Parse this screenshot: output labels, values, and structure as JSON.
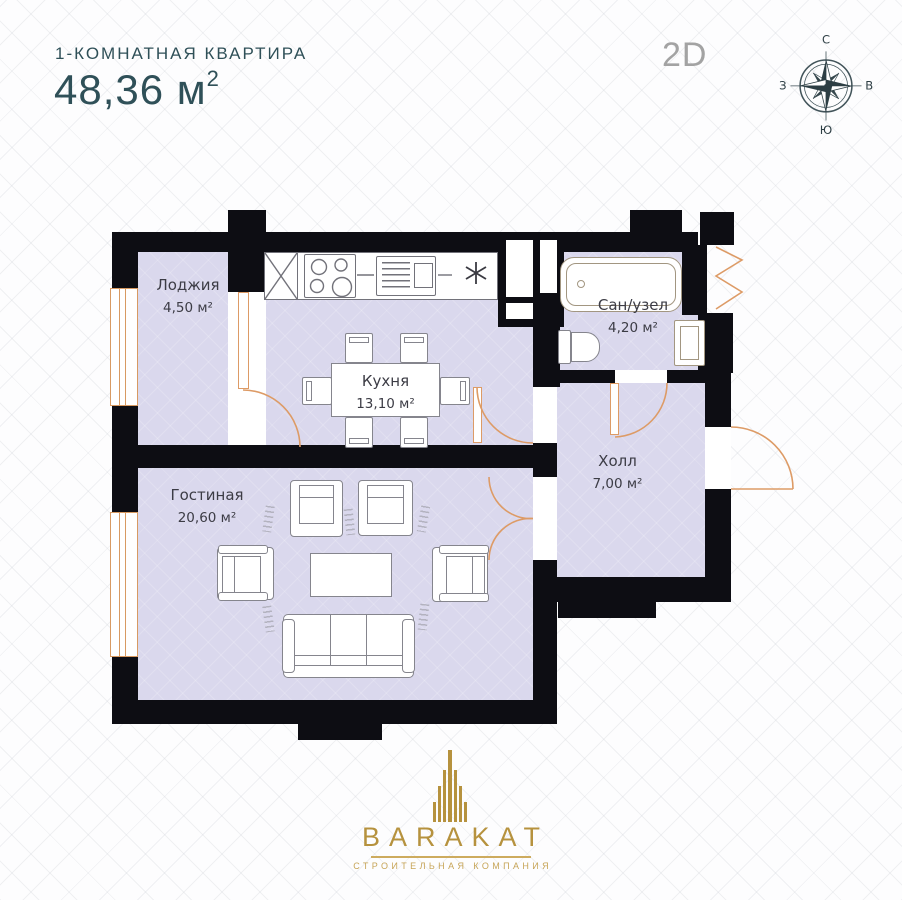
{
  "header": {
    "title": "1-КОМНАТНАЯ КВАРТИРА",
    "area_value": "48,36 м",
    "area_sup": "2",
    "view_label": "2D"
  },
  "compass": {
    "north": "С",
    "east": "В",
    "south": "Ю",
    "west": "З"
  },
  "rooms": {
    "loggia": {
      "name": "Лоджия",
      "area": "4,50 м²"
    },
    "kitchen": {
      "name": "Кухня",
      "area": "13,10 м²"
    },
    "bathroom": {
      "name": "Сан/узел",
      "area": "4,20 м²"
    },
    "hall": {
      "name": "Холл",
      "area": "7,00 м²"
    },
    "living": {
      "name": "Гостиная",
      "area": "20,60 м²"
    }
  },
  "footer": {
    "brand": "BARAKAT",
    "tagline": "СТРОИТЕЛЬНАЯ КОМПАНИЯ"
  },
  "colors": {
    "wall": "#0d0d13",
    "room_fill": "#dad8ed",
    "door_accent": "#dd9b66",
    "brand_gold": "#b6923e",
    "title_teal": "#2f5058"
  }
}
